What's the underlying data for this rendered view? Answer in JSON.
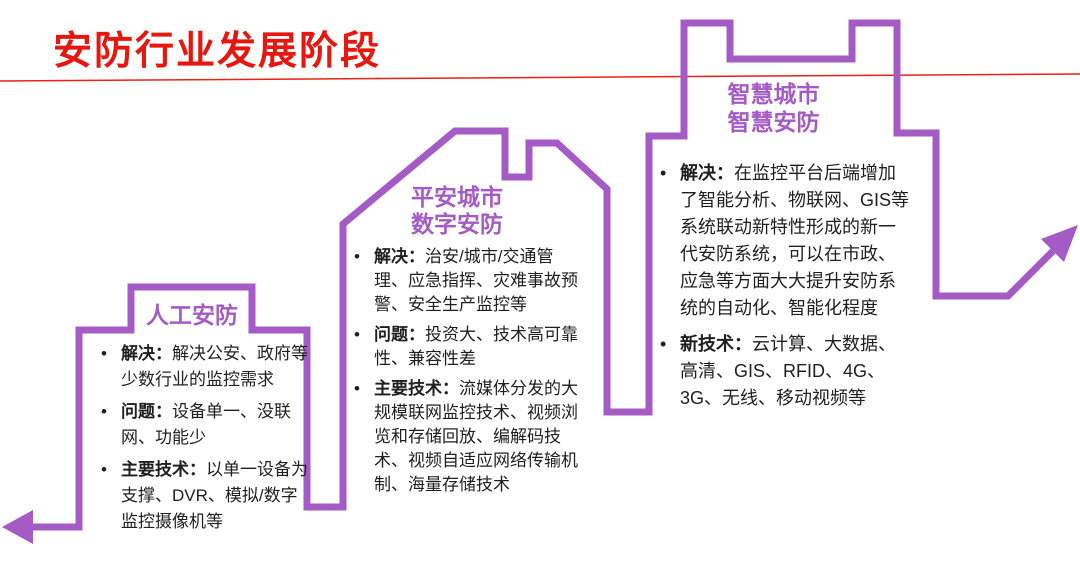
{
  "colors": {
    "purple": "#a55bc6",
    "title_red": "#e6170f",
    "rule_red": "#ee2015",
    "body_text": "#1f1f1f"
  },
  "slide": {
    "title": "安防行业发展阶段"
  },
  "stages": [
    {
      "id": "manual-security",
      "title_lines": [
        "人工安防"
      ],
      "bullets": [
        {
          "label": "解决：",
          "text": "解决公安、政府等少数行业的监控需求"
        },
        {
          "label": "问题：",
          "text": "设备单一、没联网、功能少"
        },
        {
          "label": "主要技术：",
          "text": "以单一设备为支撑、DVR、模拟/数字监控摄像机等"
        }
      ]
    },
    {
      "id": "safe-city-digital-security",
      "title_lines": [
        "平安城市",
        "数字安防"
      ],
      "bullets": [
        {
          "label": "解决：",
          "text": "治安/城市/交通管理、应急指挥、灾难事故预警、安全生产监控等"
        },
        {
          "label": "问题：",
          "text": "投资大、技术高可靠性、兼容性差"
        },
        {
          "label": "主要技术：",
          "text": "流媒体分发的大规模联网监控技术、视频浏览和存储回放、编解码技术、视频自适应网络传输机制、海量存储技术"
        }
      ]
    },
    {
      "id": "smart-city-smart-security",
      "title_lines": [
        "智慧城市",
        "智慧安防"
      ],
      "bullets": [
        {
          "label": "解决：",
          "text": "在监控平台后端增加了智能分析、物联网、GIS等系统联动新特性形成的新一代安防系统，可以在市政、应急等方面大大提升安防系统的自动化、智能化程度"
        },
        {
          "label": "新技术：",
          "text": "云计算、大数据、高清、GIS、RFID、4G、3G、无线、移动视频等"
        }
      ]
    }
  ],
  "graphic": {
    "red_line_path": "M0 81 L1080 74",
    "skyline_path": "M30 527 H79 V330 H131 V287 H252 V330 H307 V507 H343 V224 L455 131 H505 V177 H529 V143 H557 L607 189 V412 H649 V136 H684 V23 H730 V59 H852 V23 H897 V133 H936 V296 H1008 L1053 251",
    "left_arrowhead": "2,527 33,510 33,544",
    "right_arrowhead": "1078,225 1064,262 1041,239"
  }
}
